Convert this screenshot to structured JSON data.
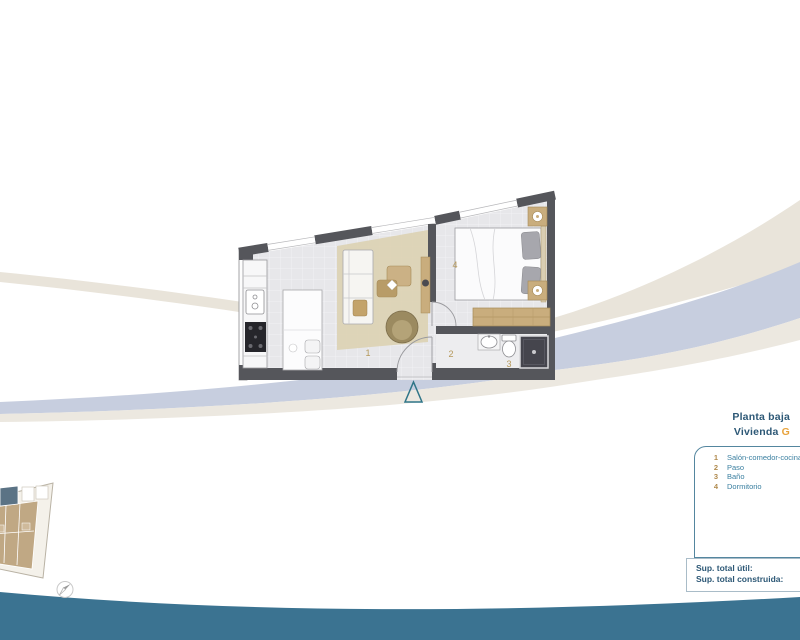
{
  "header": {
    "floor_title": "Planta baja",
    "unit_prefix": "Vivienda",
    "unit_letter": "G"
  },
  "legend": {
    "items": [
      {
        "num": "1",
        "label": "Salón-comedor-cocina"
      },
      {
        "num": "2",
        "label": "Paso"
      },
      {
        "num": "3",
        "label": "Baño"
      },
      {
        "num": "4",
        "label": "Dormitorio"
      }
    ]
  },
  "areas": {
    "useful_label": "Sup. total útil:",
    "built_label": "Sup. total construida:"
  },
  "colors": {
    "title_blue": "#2d5876",
    "legend_blue": "#3a7fa0",
    "number_tan": "#b08a4d",
    "accent_orange": "#e8a33c",
    "footer_teal": "#3b7391",
    "swoosh_blue": "#c7cedf",
    "swoosh_beige": "#e9e4da",
    "wall_gray": "#55565b",
    "entrance_marker_teal": "#2f7588"
  }
}
